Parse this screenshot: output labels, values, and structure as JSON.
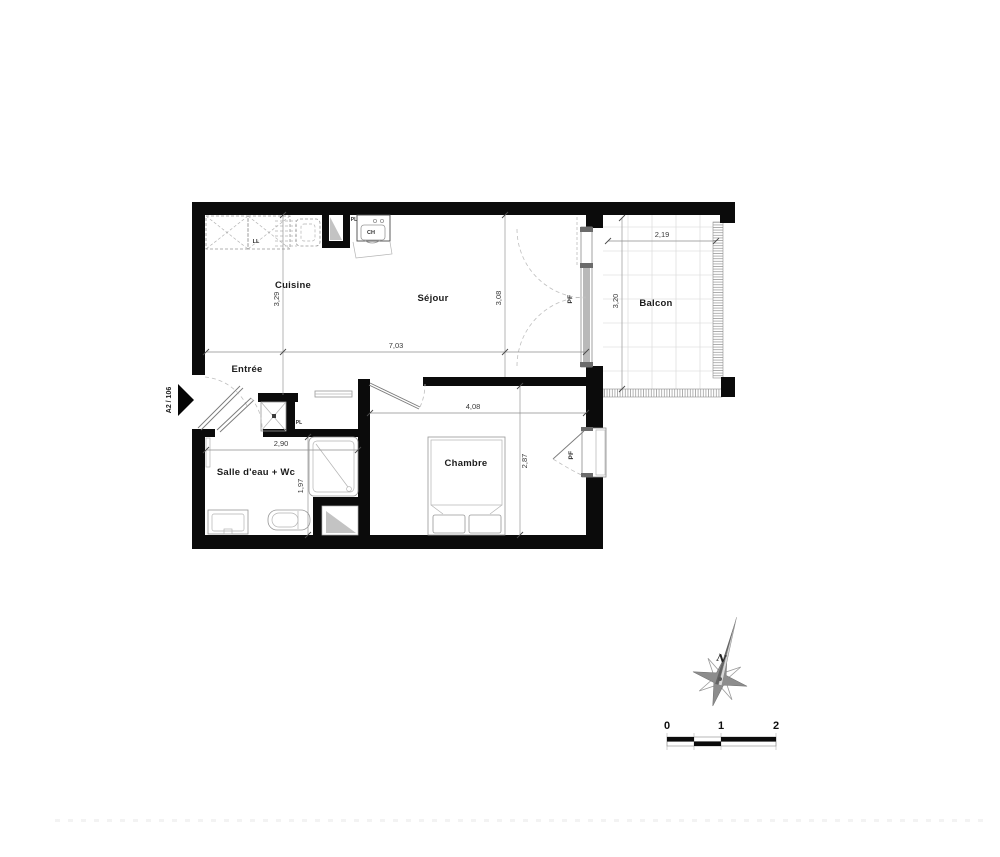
{
  "plan": {
    "unit_label": "A2 / 106",
    "rooms": {
      "cuisine": {
        "label": "Cuisine"
      },
      "sejour": {
        "label": "Séjour"
      },
      "balcon": {
        "label": "Balcon"
      },
      "entree": {
        "label": "Entrée"
      },
      "salle_eau": {
        "label": "Salle d'eau + Wc"
      },
      "chambre": {
        "label": "Chambre"
      }
    },
    "dims": {
      "cuisine_depth": "3,29",
      "living_width": "7,03",
      "sejour_depth": "3,08",
      "balcon_width": "2,19",
      "balcon_depth": "3,20",
      "chambre_width": "4,08",
      "chambre_depth": "2,87",
      "salle_eau_width": "2,90",
      "salle_eau_depth": "1,97"
    },
    "fixtures": {
      "washing_machine": "LL",
      "kitchen_closet": "PL",
      "water_heater": "CH",
      "entry_closet": "PL",
      "sejour_window": "PF",
      "chambre_window": "PF"
    },
    "compass": {
      "north": "N"
    },
    "scale_bar": {
      "ticks": [
        "0",
        "1",
        "2"
      ]
    },
    "colors": {
      "wall": "#0b0b0b",
      "line_gray": "#979797",
      "hatch_gray": "#a8a8a8",
      "label": "#1c1c1c"
    }
  }
}
